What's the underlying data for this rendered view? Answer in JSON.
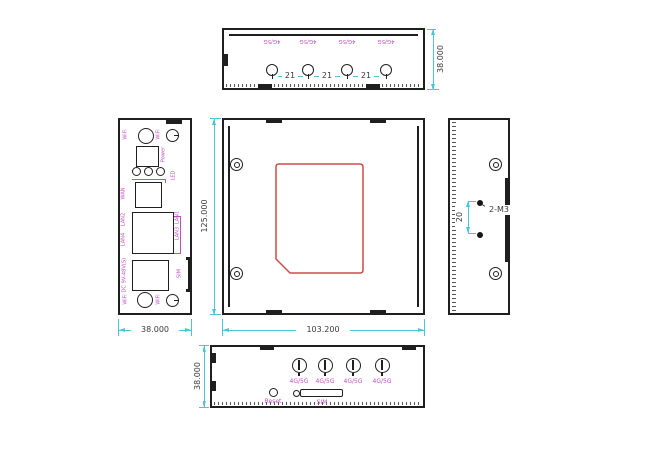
{
  "colors": {
    "outline": "#1f1f1f",
    "dimension_line": "#4ac6da",
    "dimension_text": "#3a3a3a",
    "port_label": "#c050c0",
    "sim_cover_outline": "#cd4a4a"
  },
  "views": {
    "top": {
      "antenna_labels": [
        "4G/5G",
        "4G/5G",
        "4G/5G",
        "4G/5G"
      ],
      "pitch_dims": [
        "21",
        "21",
        "21"
      ],
      "height_dim": "38.000"
    },
    "left": {
      "width_dim": "38.000",
      "top_antenna_labels": [
        "WiFi",
        "WiFi"
      ],
      "power_label": "Power",
      "led_label": "LED",
      "wan_label": "WAN",
      "lan_left_labels": [
        "LAN2",
        "LAN4"
      ],
      "lan_right_labels": [
        "LAN1",
        "LAN3"
      ],
      "dc_label": "DC 9V-48V(S)",
      "sim_edge_label": "SIM",
      "bottom_antenna_labels": [
        "WiFi",
        "WiFi"
      ]
    },
    "front": {
      "height_dim": "125.000",
      "width_dim": "103.200"
    },
    "right": {
      "pitch_dim": "20",
      "thread_label": "2-M3"
    },
    "bottom": {
      "height_dim": "38.000",
      "antenna_labels": [
        "4G/5G",
        "4G/5G",
        "4G/5G",
        "4G/5G"
      ],
      "reset_label": "Reset",
      "sim_label": "SIM"
    }
  }
}
